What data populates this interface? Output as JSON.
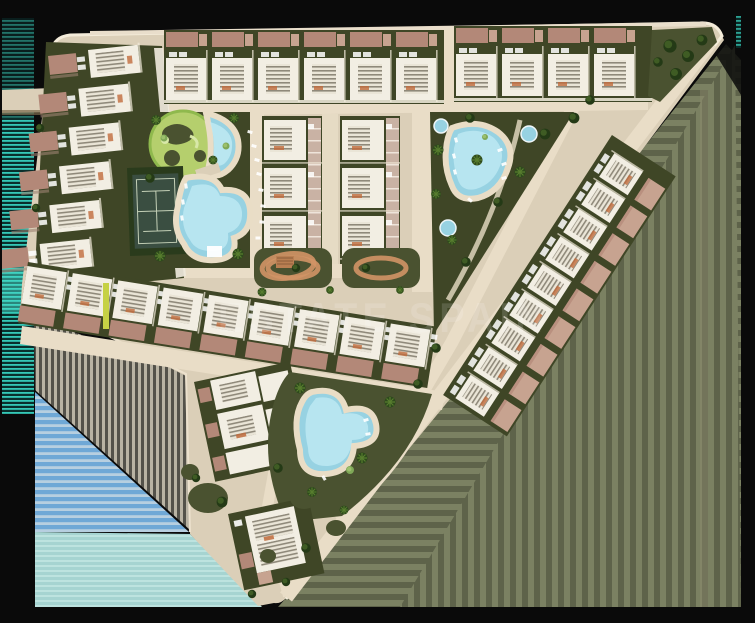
{
  "image": {
    "kind": "architectural-masterplan-render",
    "description": "Aerial 2D site plan of a residential resort development with terraced houses, apartment blocks, swimming pools, a tennis court and landscaped gardens, rendered on a black background with striped compression-glitch artifacts"
  },
  "watermark": {
    "text": "ESTATE SPAIN"
  },
  "palette": {
    "frame_black": "#0a0a0a",
    "ground": "#dbcfb8",
    "road": "#e9ddc7",
    "curb": "#f4ecda",
    "garden_dark": "#3f4626",
    "garden_dark2": "#4a5230",
    "roof_brick": "#b38878",
    "roof_brick_light": "#c7a390",
    "building_white": "#f2eee3",
    "stair_bg": "#eae5d7",
    "stair_line": "#8f897a",
    "paved_strip": "#c9b2a4",
    "pool_edge": "#69b9d4",
    "pool_main": "#97d2e2",
    "pool_light": "#c2ebf4",
    "lawn_light": "#b5cf6d",
    "lawn_mid": "#8fb94d",
    "tennis_hedge": "#2a3b1c",
    "tennis_court": "#3a4e41",
    "tennis_line": "#c3cfb6",
    "terracotta": "#d29466",
    "orange_tick": "#c06b3c",
    "tree_dark": "#243a16",
    "tree_mid": "#3f5c24",
    "tree_light": "#7fa857",
    "glitch_teal": "#35c8b7",
    "glitch_teal_dark": "#0a2f2c",
    "glitch_blue": "#6fa8d6",
    "glitch_blue_pale": "#b7cfe0",
    "glitch_cyan": "#a6d4d1",
    "glitch_cyan_light": "#bde3df",
    "glitch_gray_light": "#b9b3a3",
    "glitch_gray_dark": "#54524a",
    "glitch_olive": "#6d7254",
    "glitch_olive_light": "#7b8162",
    "glitch_olive_dark": "#5e634a"
  },
  "site": {
    "left_row_units": 6,
    "left_row_roofs": 6,
    "top_row_a_units": 6,
    "top_row_a_roofs": 6,
    "top_row_b_units": 4,
    "top_row_b_roofs": 4,
    "middle_row_units": 9,
    "diagonal_row_units": 9,
    "diagonal_row_roofs": 9,
    "apartment_columns": 2,
    "buildings_per_column": 3,
    "tennis_courts": 1,
    "pools": {
      "lagoon_pools": 2,
      "teardrop_pools": 1,
      "round_pools": 3,
      "south_pools": 1
    }
  }
}
